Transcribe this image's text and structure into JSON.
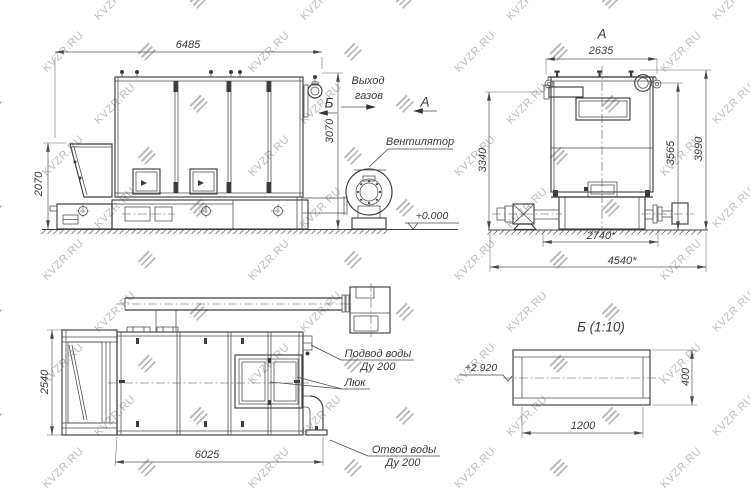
{
  "watermark": {
    "text": "KVZR.RU"
  },
  "views": {
    "side": {
      "dims": {
        "length": "6485",
        "height": "3070",
        "hopper_height": "2070"
      },
      "labels": {
        "gas_exit_line1": "Выход",
        "gas_exit_line2": "газов",
        "section_marker": "Б",
        "view_marker": "А",
        "fan": "Вентилятор",
        "ground_level": "+0.000"
      }
    },
    "front": {
      "title": "А",
      "dims": {
        "width": "2635",
        "left_height": "3340",
        "right_height_inner": "3565",
        "right_height_outer": "3990",
        "bottom_inner": "2740*",
        "bottom_outer": "4540*"
      }
    },
    "plan": {
      "dims": {
        "depth": "2540",
        "length": "6025"
      },
      "labels": {
        "water_inlet_line1": "Подвод воды",
        "water_inlet_line2": "Ду 200",
        "hatch": "Люк",
        "water_outlet_line1": "Отвод воды",
        "water_outlet_line2": "Ду 200"
      }
    },
    "section": {
      "title": "Б (1:10)",
      "dims": {
        "width": "1200",
        "height": "400"
      },
      "labels": {
        "level": "+2.920"
      }
    }
  },
  "colors": {
    "line": "#474747",
    "text": "#3a3a3a",
    "watermark": "#bcbcbc",
    "background": "#ffffff"
  }
}
